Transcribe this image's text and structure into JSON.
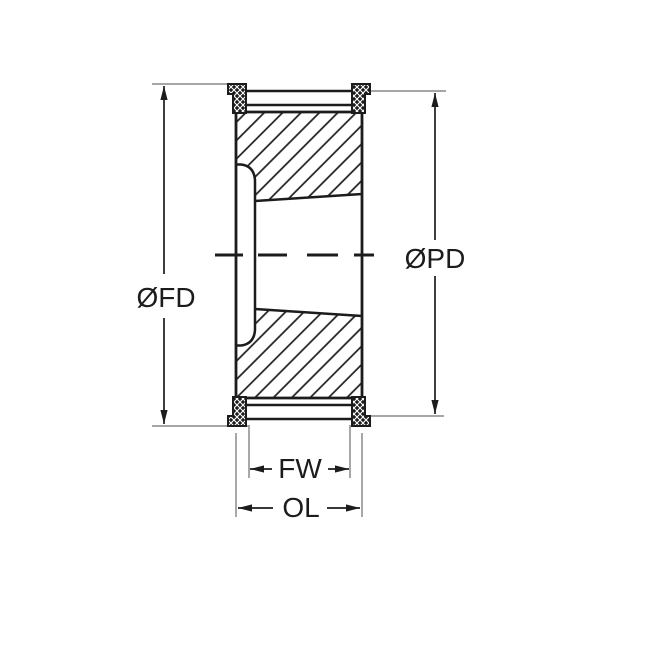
{
  "diagram": {
    "labels": {
      "flange_diameter": "ØFD",
      "pitch_diameter": "ØPD",
      "face_width": "FW",
      "overall_length": "OL"
    },
    "colors": {
      "line": "#1c1c1c",
      "extension_line": "#999999",
      "background": "#ffffff"
    }
  }
}
